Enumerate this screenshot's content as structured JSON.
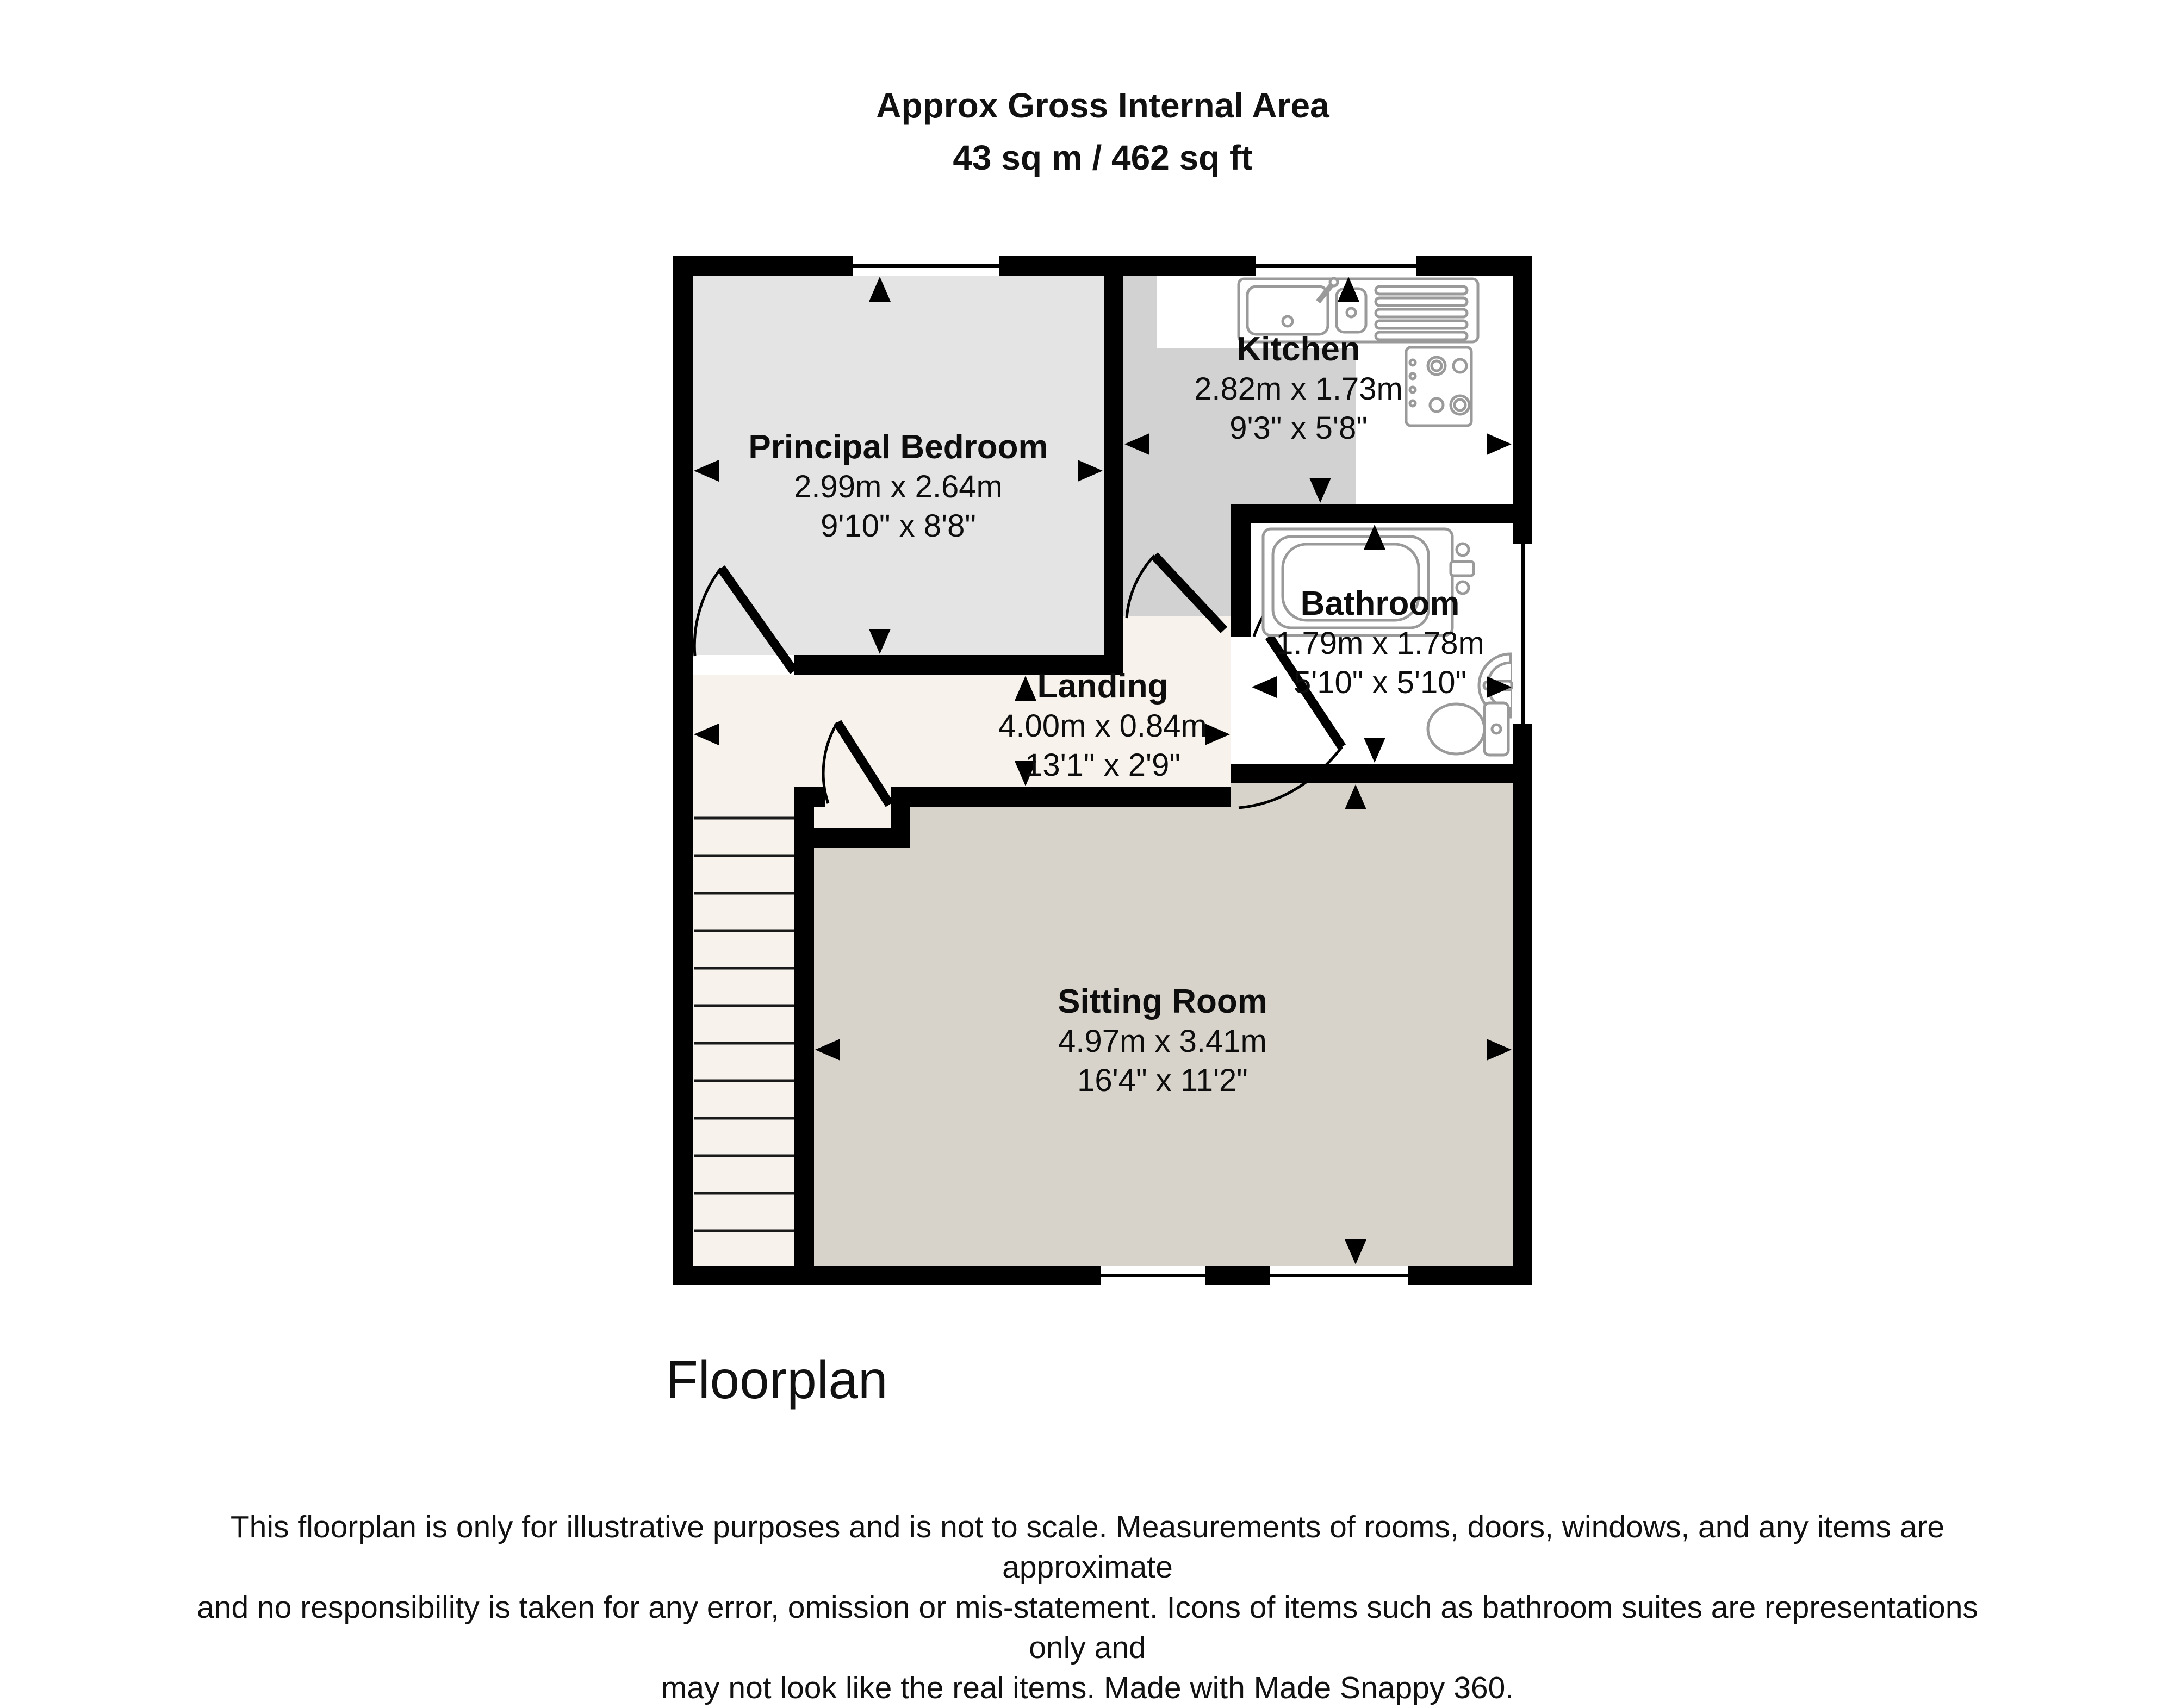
{
  "title": {
    "line1": "Approx Gross Internal Area",
    "line2": "43 sq m / 462 sq ft"
  },
  "rooms": {
    "bedroom": {
      "name": "Principal Bedroom",
      "metric": "2.99m x 2.64m",
      "imperial": "9'10\" x 8'8\""
    },
    "kitchen": {
      "name": "Kitchen",
      "metric": "2.82m x 1.73m",
      "imperial": "9'3\" x 5'8\""
    },
    "bathroom": {
      "name": "Bathroom",
      "metric": "1.79m x 1.78m",
      "imperial": "5'10\" x 5'10\""
    },
    "landing": {
      "name": "Landing",
      "metric": "4.00m x 0.84m",
      "imperial": "13'1\" x 2'9\""
    },
    "sitting_room": {
      "name": "Sitting Room",
      "metric": "4.97m x 3.41m",
      "imperial": "16'4\" x 11'2\""
    }
  },
  "footer": {
    "plan_label": "Floorplan",
    "disclaimer_line1": "This floorplan is only for illustrative purposes and is not to scale. Measurements of rooms, doors, windows, and any items are approximate",
    "disclaimer_line2": "and no responsibility is taken for any error, omission or mis-statement. Icons of items such as bathroom suites are representations only and",
    "disclaimer_line3": "may not look like the real items. Made with Made Snappy 360."
  },
  "icons": [
    "kitchen-sink-icon",
    "hob-icon",
    "bathtub-icon",
    "basin-icon",
    "toilet-icon",
    "staircase",
    "door-arc",
    "window-symbol",
    "measure-arrow"
  ],
  "colors": {
    "wall": "#000000",
    "bedroom_floor": "#e4e4e4",
    "kitchen_floor": "#d2d2d2",
    "landing_floor": "#f7f3ec",
    "sitting_room_floor": "#d8d3ca",
    "bathroom_floor": "#ffffff",
    "fixture_outline": "#9a9a9a"
  }
}
